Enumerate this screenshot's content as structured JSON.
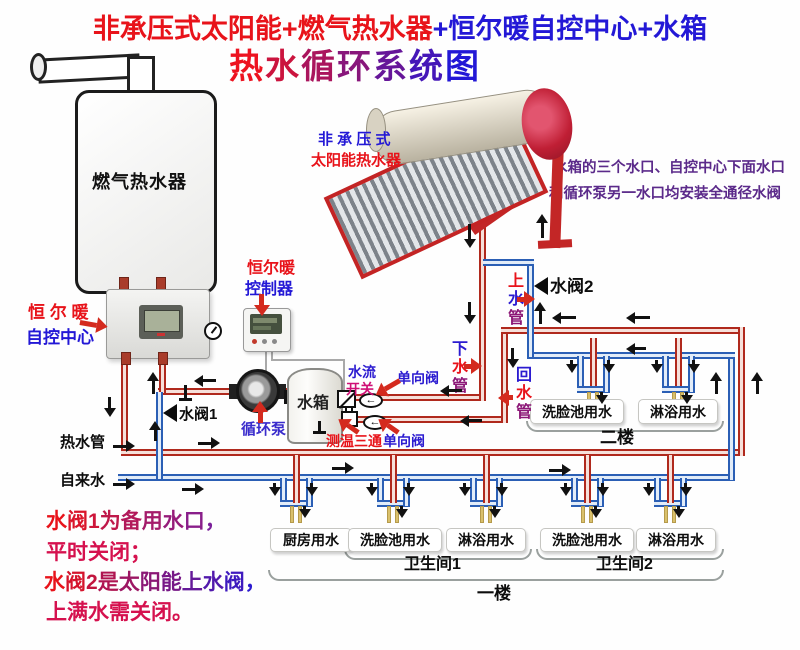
{
  "title": {
    "line1_red": "非承压式太阳能+燃气热水器",
    "line1_blue": "+恒尔暖自控中心+水箱",
    "line2": "热水循环系统图"
  },
  "devices": {
    "gas_heater": "燃气热水器",
    "control_center_line1": "恒 尔 暖",
    "control_center_line2": "自控中心",
    "solar_line1": "非 承 压 式",
    "solar_line2": "太阳能热水器",
    "controller_line1": "恒尔暖",
    "controller_line2": "控制器",
    "pump": "循环泵",
    "tank": "水箱"
  },
  "components": {
    "flow_switch_line1": "水流",
    "flow_switch_line2": "开关",
    "check_valve_top": "单向阀",
    "check_valve_bottom": "单向阀",
    "temp_tee": "测温三通",
    "valve1": "水阀1",
    "valve2": "水阀2"
  },
  "pipes": {
    "supply_up": [
      "上",
      "水",
      "管"
    ],
    "down": [
      "下",
      "水",
      "管"
    ],
    "return": [
      "回",
      "水",
      "管"
    ],
    "hot": "热水管",
    "tap": "自来水"
  },
  "notes": {
    "right_line1": "水箱的三个水口、自控中心下面水口",
    "right_line2": "和循环泵另一水口均安装全通径水阀",
    "bottom_line1": "水阀1为备用水口，",
    "bottom_line2": "平时关闭；",
    "bottom_line3": "水阀2是太阳能上水阀，",
    "bottom_line4": "上满水需关闭。"
  },
  "floors": {
    "f2": {
      "label": "二楼",
      "fixtures": [
        "洗脸池用水",
        "淋浴用水"
      ]
    },
    "f1": {
      "label": "一楼",
      "kitchen": "厨房用水",
      "bath1": {
        "label": "卫生间1",
        "fixtures": [
          "洗脸池用水",
          "淋浴用水"
        ]
      },
      "bath2": {
        "label": "卫生间2",
        "fixtures": [
          "洗脸池用水",
          "淋浴用水"
        ]
      }
    }
  },
  "colors": {
    "red": "#e8131a",
    "blue": "#2318d6",
    "purple": "#8c1777",
    "magenta": "#d5114e",
    "note_purple": "#5b2a8a",
    "pipe_red": "#b0291d",
    "pipe_blue": "#2b5fb5"
  }
}
